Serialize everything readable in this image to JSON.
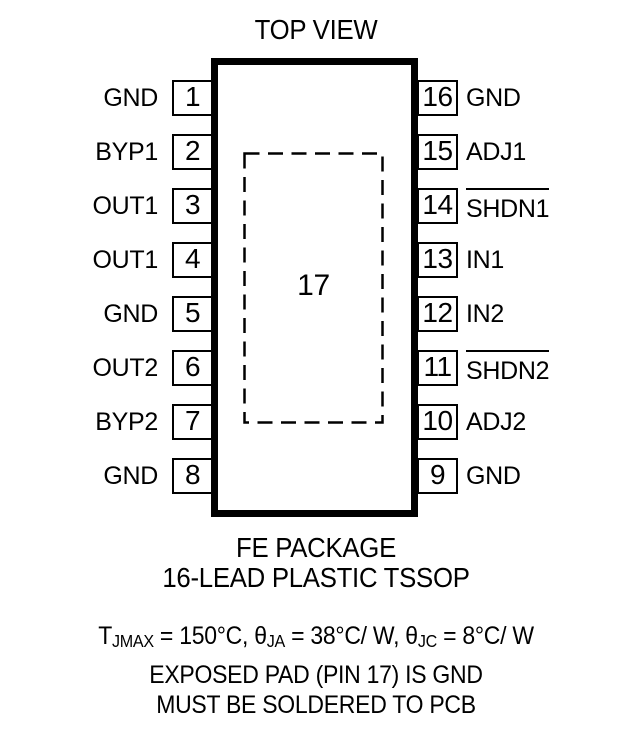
{
  "title": "TOP VIEW",
  "package": {
    "name_line1": "FE PACKAGE",
    "name_line2": "16-LEAD PLASTIC TSSOP"
  },
  "exposed_pad": {
    "number": "17"
  },
  "pins": {
    "left": [
      {
        "number": "1",
        "name": "GND",
        "overline": false
      },
      {
        "number": "2",
        "name": "BYP1",
        "overline": false
      },
      {
        "number": "3",
        "name": "OUT1",
        "overline": false
      },
      {
        "number": "4",
        "name": "OUT1",
        "overline": false
      },
      {
        "number": "5",
        "name": "GND",
        "overline": false
      },
      {
        "number": "6",
        "name": "OUT2",
        "overline": false
      },
      {
        "number": "7",
        "name": "BYP2",
        "overline": false
      },
      {
        "number": "8",
        "name": "GND",
        "overline": false
      }
    ],
    "right": [
      {
        "number": "16",
        "name": "GND",
        "overline": false
      },
      {
        "number": "15",
        "name": "ADJ1",
        "overline": false
      },
      {
        "number": "14",
        "name": "SHDN1",
        "overline": true
      },
      {
        "number": "13",
        "name": "IN1",
        "overline": false
      },
      {
        "number": "12",
        "name": "IN2",
        "overline": false
      },
      {
        "number": "11",
        "name": "SHDN2",
        "overline": true
      },
      {
        "number": "10",
        "name": "ADJ2",
        "overline": false
      },
      {
        "number": "9",
        "name": "GND",
        "overline": false
      }
    ]
  },
  "notes": {
    "thermal": {
      "t_sym": "T",
      "t_sub": "JMAX",
      "t_rest": " = 150°C, ",
      "theta1_sym": "θ",
      "theta1_sub": "JA",
      "theta1_rest": " = 38°C/ W, ",
      "theta2_sym": "θ",
      "theta2_sub": "JC",
      "theta2_rest": " = 8°C/ W"
    },
    "exposed_pad_note": "EXPOSED PAD (PIN 17) IS GND",
    "solder_note": "MUST BE SOLDERED TO PCB"
  },
  "layout_hints": {
    "row_top_start_px": 80,
    "row_pitch_px": 54
  },
  "colors": {
    "ink": "#000000",
    "background": "#ffffff"
  }
}
